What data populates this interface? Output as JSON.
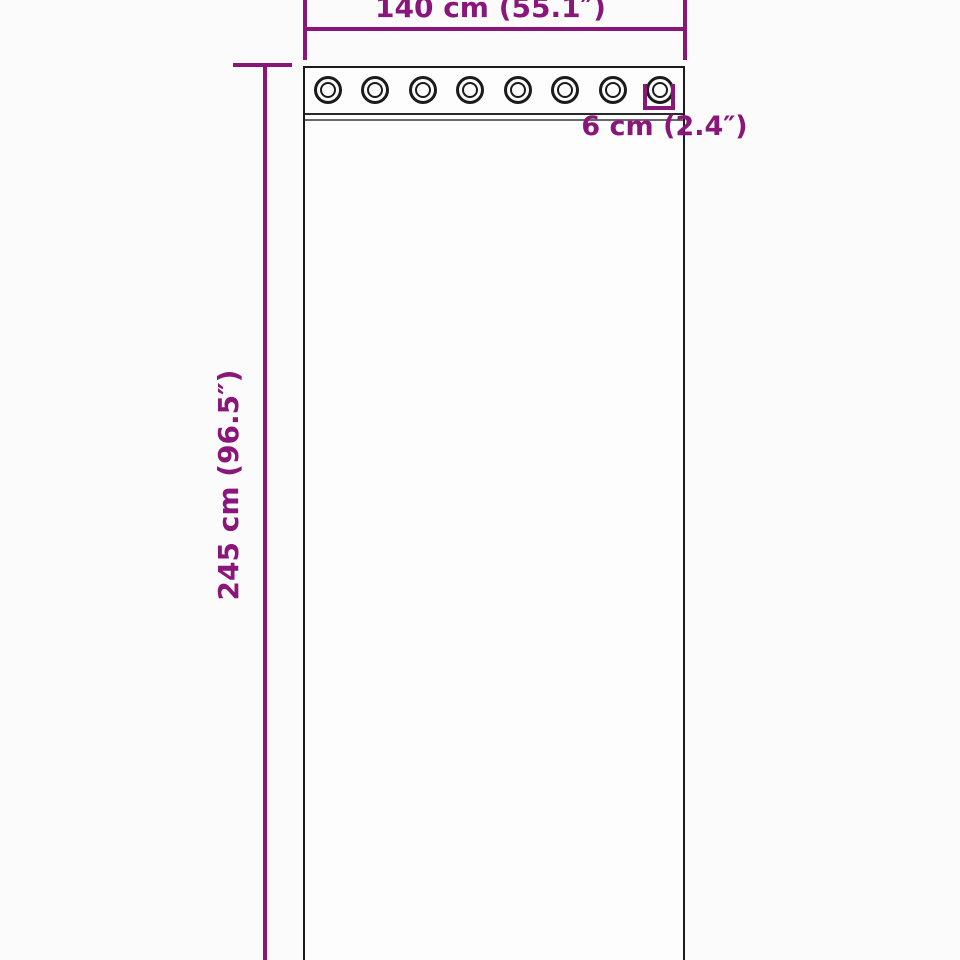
{
  "diagram": {
    "width_label": "140 cm (55.1″)",
    "height_label": "245 cm (96.5″)",
    "grommet_label": "6 cm (2.4″)",
    "grommet_count": 8,
    "colors": {
      "dimension": "#8a1679",
      "outline": "#1b1b1b",
      "panel": "#fdfdfd",
      "background": "#fbfbfb"
    }
  }
}
